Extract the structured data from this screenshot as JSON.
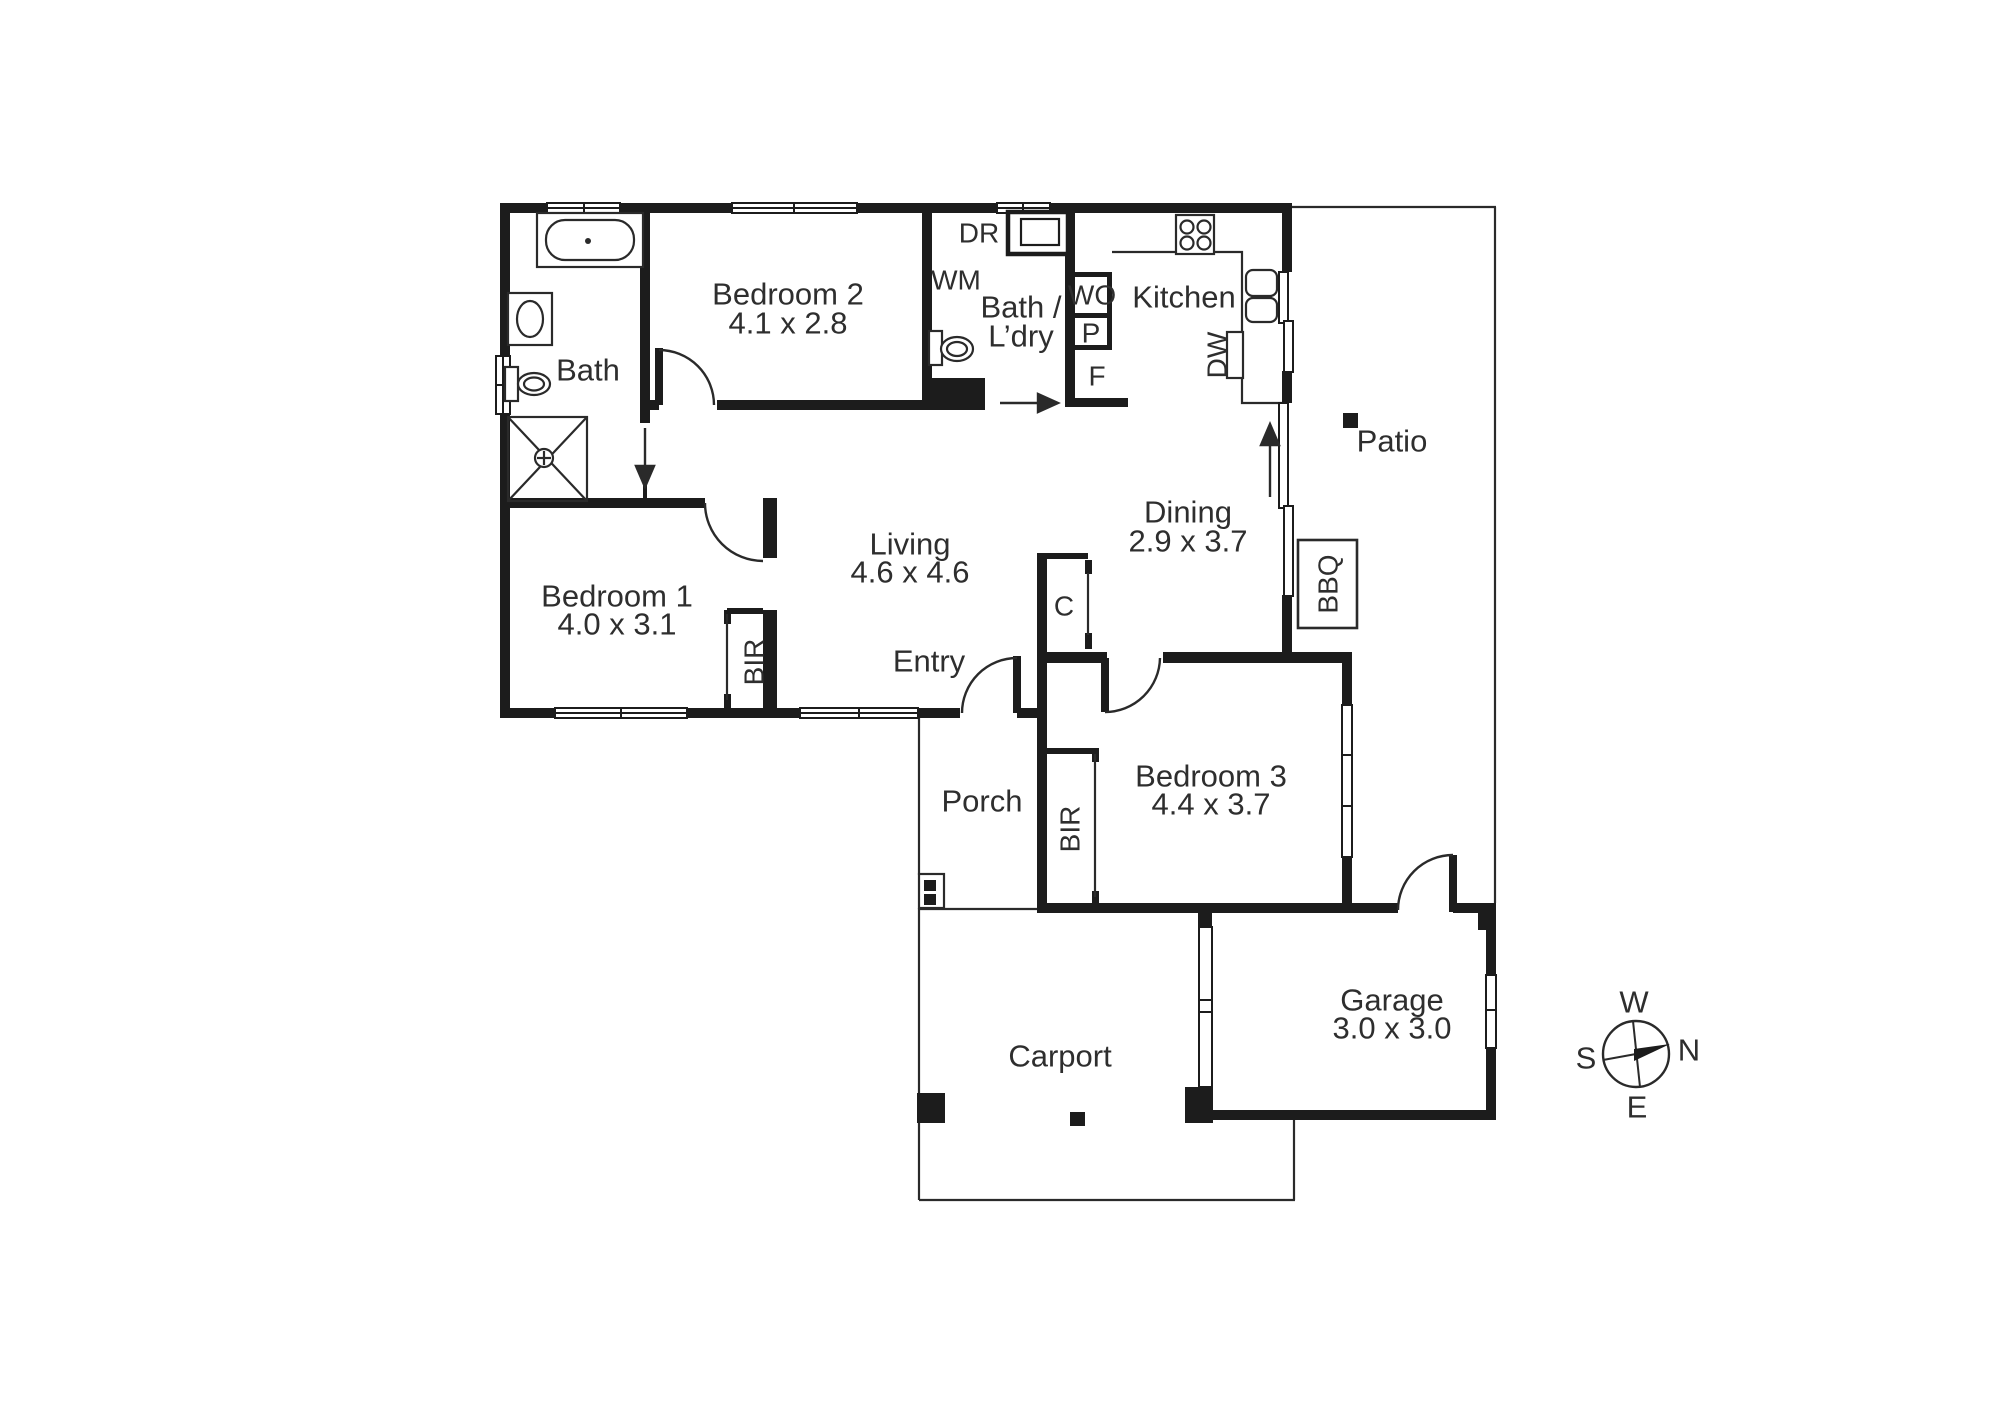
{
  "rooms": {
    "bath": {
      "name": "Bath"
    },
    "bedroom2": {
      "name": "Bedroom 2",
      "dims": "4.1 x 2.8"
    },
    "bathldry": {
      "name_line1": "Bath /",
      "name_line2": "L’dry"
    },
    "kitchen": {
      "name": "Kitchen"
    },
    "patio": {
      "name": "Patio"
    },
    "dining": {
      "name": "Dining",
      "dims": "2.9 x 3.7"
    },
    "living": {
      "name": "Living",
      "dims": "4.6 x 4.6"
    },
    "entry": {
      "name": "Entry"
    },
    "bedroom1": {
      "name": "Bedroom 1",
      "dims": "4.0 x 3.1"
    },
    "porch": {
      "name": "Porch"
    },
    "bedroom3": {
      "name": "Bedroom 3",
      "dims": "4.4 x 3.7"
    },
    "carport": {
      "name": "Carport"
    },
    "garage": {
      "name": "Garage",
      "dims": "3.0 x 3.0"
    }
  },
  "labels": {
    "dryer": "DR",
    "washing_machine": "WM",
    "wall_oven": "WO",
    "pantry": "P",
    "fridge": "F",
    "dishwasher": "DW",
    "closet": "C",
    "bbq": "BBQ",
    "robe_bedroom1": "BIR",
    "robe_bedroom3": "BIR"
  },
  "compass": {
    "north": "N",
    "south": "S",
    "east": "E",
    "west": "W"
  },
  "colors": {
    "wall": "#1c1c1c",
    "line": "#2a2a2a",
    "text": "#2e2e2e",
    "background": "#ffffff"
  }
}
